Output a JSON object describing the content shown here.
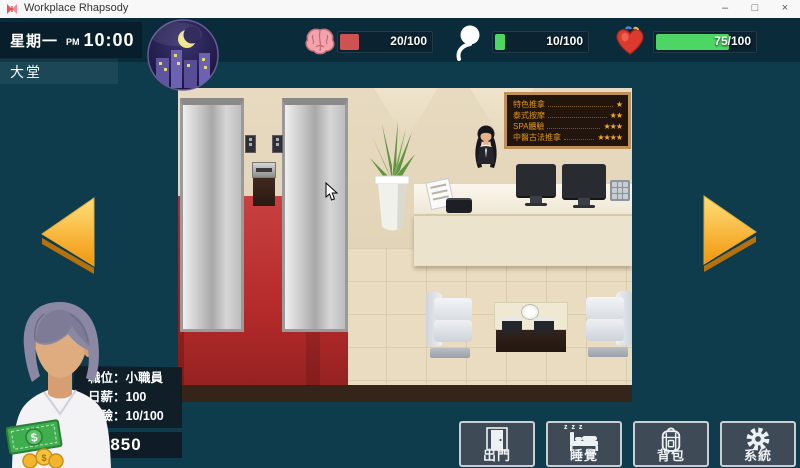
{
  "window": {
    "title": "Workplace Rhapsody",
    "minimize": "–",
    "maximize": "□",
    "close": "×"
  },
  "hud": {
    "day": "星期一",
    "meridiem": "PM",
    "time": "10:00",
    "location": "大堂",
    "stats": [
      {
        "id": "brain",
        "value": "20/100",
        "width": "20%",
        "fill": "#cf5252"
      },
      {
        "id": "spirit",
        "value": "10/100",
        "width": "10%",
        "fill": "#4dd663"
      },
      {
        "id": "health",
        "value": "75/100",
        "width": "72%",
        "fill": "#4dd663"
      }
    ]
  },
  "scene": {
    "menu_board": {
      "items": [
        {
          "label": "特色推拿",
          "stars": "★"
        },
        {
          "label": "泰式按摩",
          "stars": "★★"
        },
        {
          "label": "SPA體驗",
          "stars": "★★★"
        },
        {
          "label": "中醫古法推拿",
          "stars": "★★★★"
        }
      ]
    }
  },
  "player": {
    "position": "職位：小職員",
    "salary": "日薪：100",
    "experience": "經驗：10/100",
    "money": "850"
  },
  "actions": [
    {
      "label": "出門"
    },
    {
      "label": "睡覺"
    },
    {
      "label": "背包"
    },
    {
      "label": "系統"
    }
  ],
  "colors": {
    "bg": "#0e3c4d",
    "stat_red": "#cf5252",
    "stat_green": "#4dd663",
    "arrow": "#f5a623"
  }
}
